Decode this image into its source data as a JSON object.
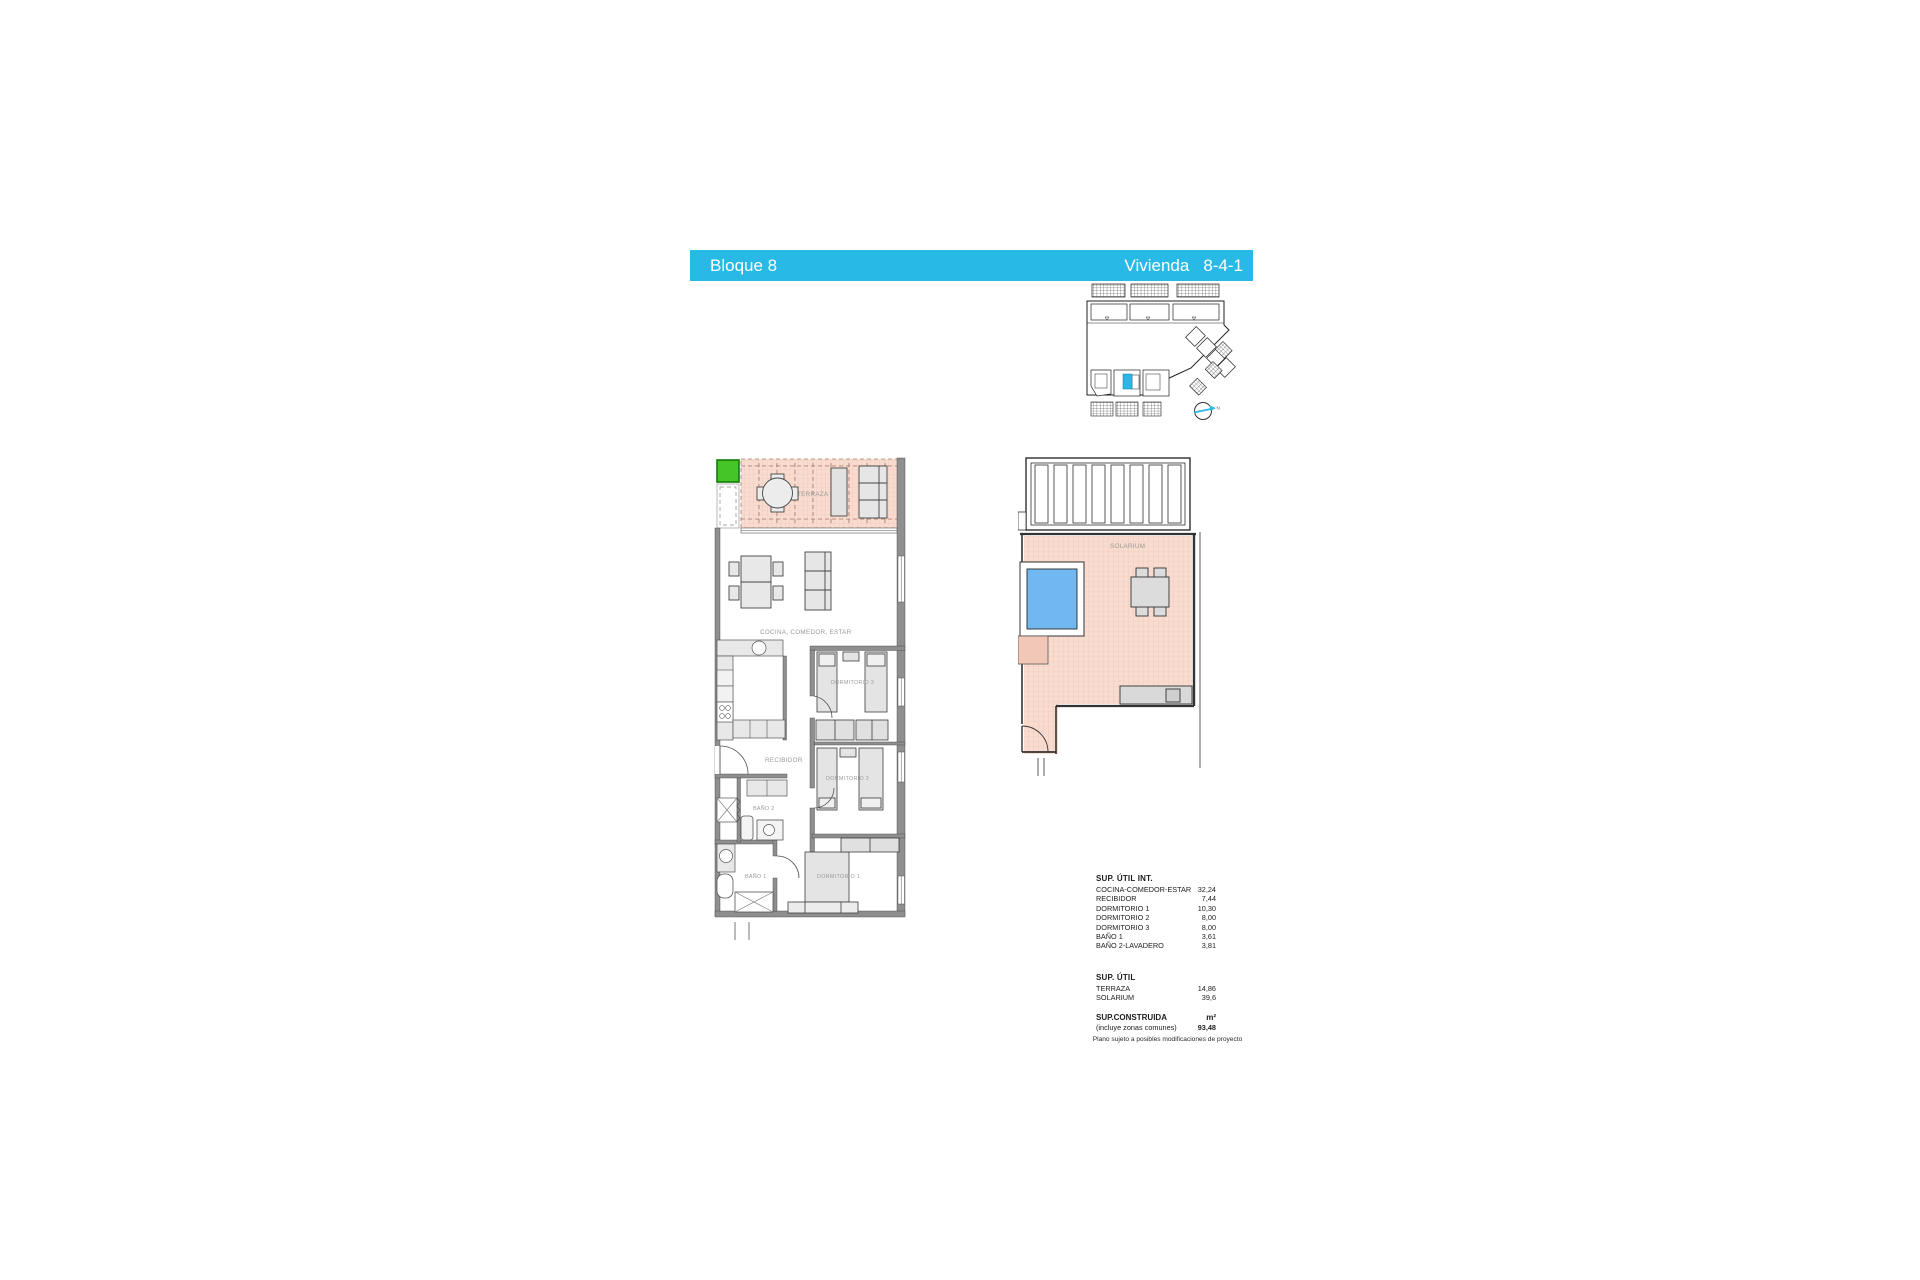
{
  "header": {
    "block_label": "Bloque 8",
    "unit_label": "Vivienda",
    "unit_number": "8-4-1"
  },
  "colors": {
    "accent_cyan": "#29b9e6",
    "terrace_pink": "#f8dcd0",
    "pool_blue": "#72b8f0",
    "highlight_green": "#46c528"
  },
  "floor_plan": {
    "labels": {
      "terraza": "TERRAZA",
      "cocina_comedor_estar": "COCINA, COMEDOR, ESTAR",
      "recibidor": "RECIBIDOR",
      "dormitorio_1": "DORMITORIO 1",
      "dormitorio_2": "DORMITORIO 2",
      "dormitorio_3": "DORMITORIO 3",
      "bano_1": "BAÑO 1",
      "bano_2": "BAÑO 2"
    }
  },
  "solarium_plan": {
    "label": "SOLARIUM"
  },
  "site_plan": {
    "compass_label": "N"
  },
  "areas_table": {
    "util_int": {
      "title": "SUP. ÚTIL INT.",
      "rows": [
        {
          "label": "COCINA-COMEDOR-ESTAR",
          "value": "32,24"
        },
        {
          "label": "RECIBIDOR",
          "value": "7,44"
        },
        {
          "label": "DORMITORIO 1",
          "value": "10,30"
        },
        {
          "label": "DORMITORIO 2",
          "value": "8,00"
        },
        {
          "label": "DORMITORIO 3",
          "value": "8,00"
        },
        {
          "label": "BAÑO 1",
          "value": "3,61"
        },
        {
          "label": "BAÑO 2-LAVADERO",
          "value": "3,81"
        }
      ]
    },
    "util": {
      "title": "SUP. ÚTIL",
      "rows": [
        {
          "label": "TERRAZA",
          "value": "14,86"
        },
        {
          "label": "SOLARIUM",
          "value": "39,6"
        }
      ]
    },
    "construida": {
      "title": "SUP.CONSTRUIDA",
      "unit": "m²",
      "note": "(incluye zonas comunes)",
      "value": "93,48"
    },
    "disclaimer": "Plano sujeto a posibles modificaciones de proyecto"
  }
}
